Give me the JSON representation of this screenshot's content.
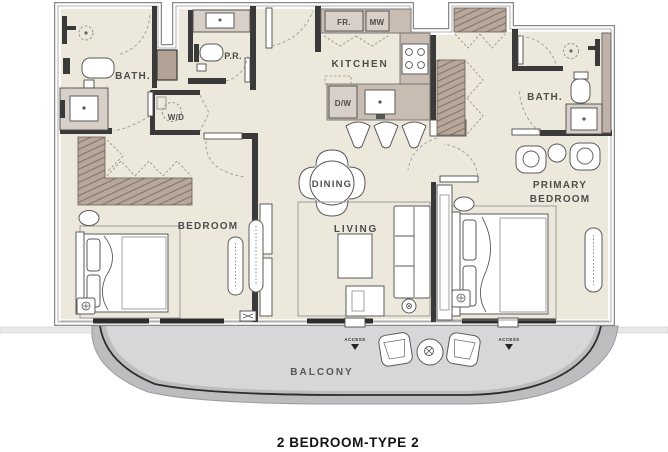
{
  "title": "2 BEDROOM-TYPE 2",
  "plan": {
    "labels": {
      "bath_left": "BATH.",
      "powder_room": "P.R.",
      "fridge": "FR.",
      "microwave": "MW",
      "kitchen": "KITCHEN",
      "dishwasher": "D/W",
      "washer_dryer": "W/D",
      "dining": "DINING",
      "living": "LIVING",
      "bedroom": "BEDROOM",
      "bath_right": "BATH.",
      "primary_bedroom_line1": "PRIMARY",
      "primary_bedroom_line2": "BEDROOM",
      "balcony": "BALCONY",
      "access_left": "ACCESS",
      "access_right": "ACCESS"
    },
    "colors": {
      "floor": "#ece9dc",
      "interior_wall": "#3a3a3a",
      "exterior_wall_edge": "#8a8a8a",
      "wardrobe": "#b7a89b",
      "wardrobe_hatch": "#8a7a6d",
      "counter": "#d8cfc8",
      "cabinet": "#c9bcb2",
      "balcony_band": "#bdbcbf",
      "balcony_floor": "#d7d6d9",
      "label_text": "#4d4d4d",
      "title_text": "#141414"
    }
  }
}
